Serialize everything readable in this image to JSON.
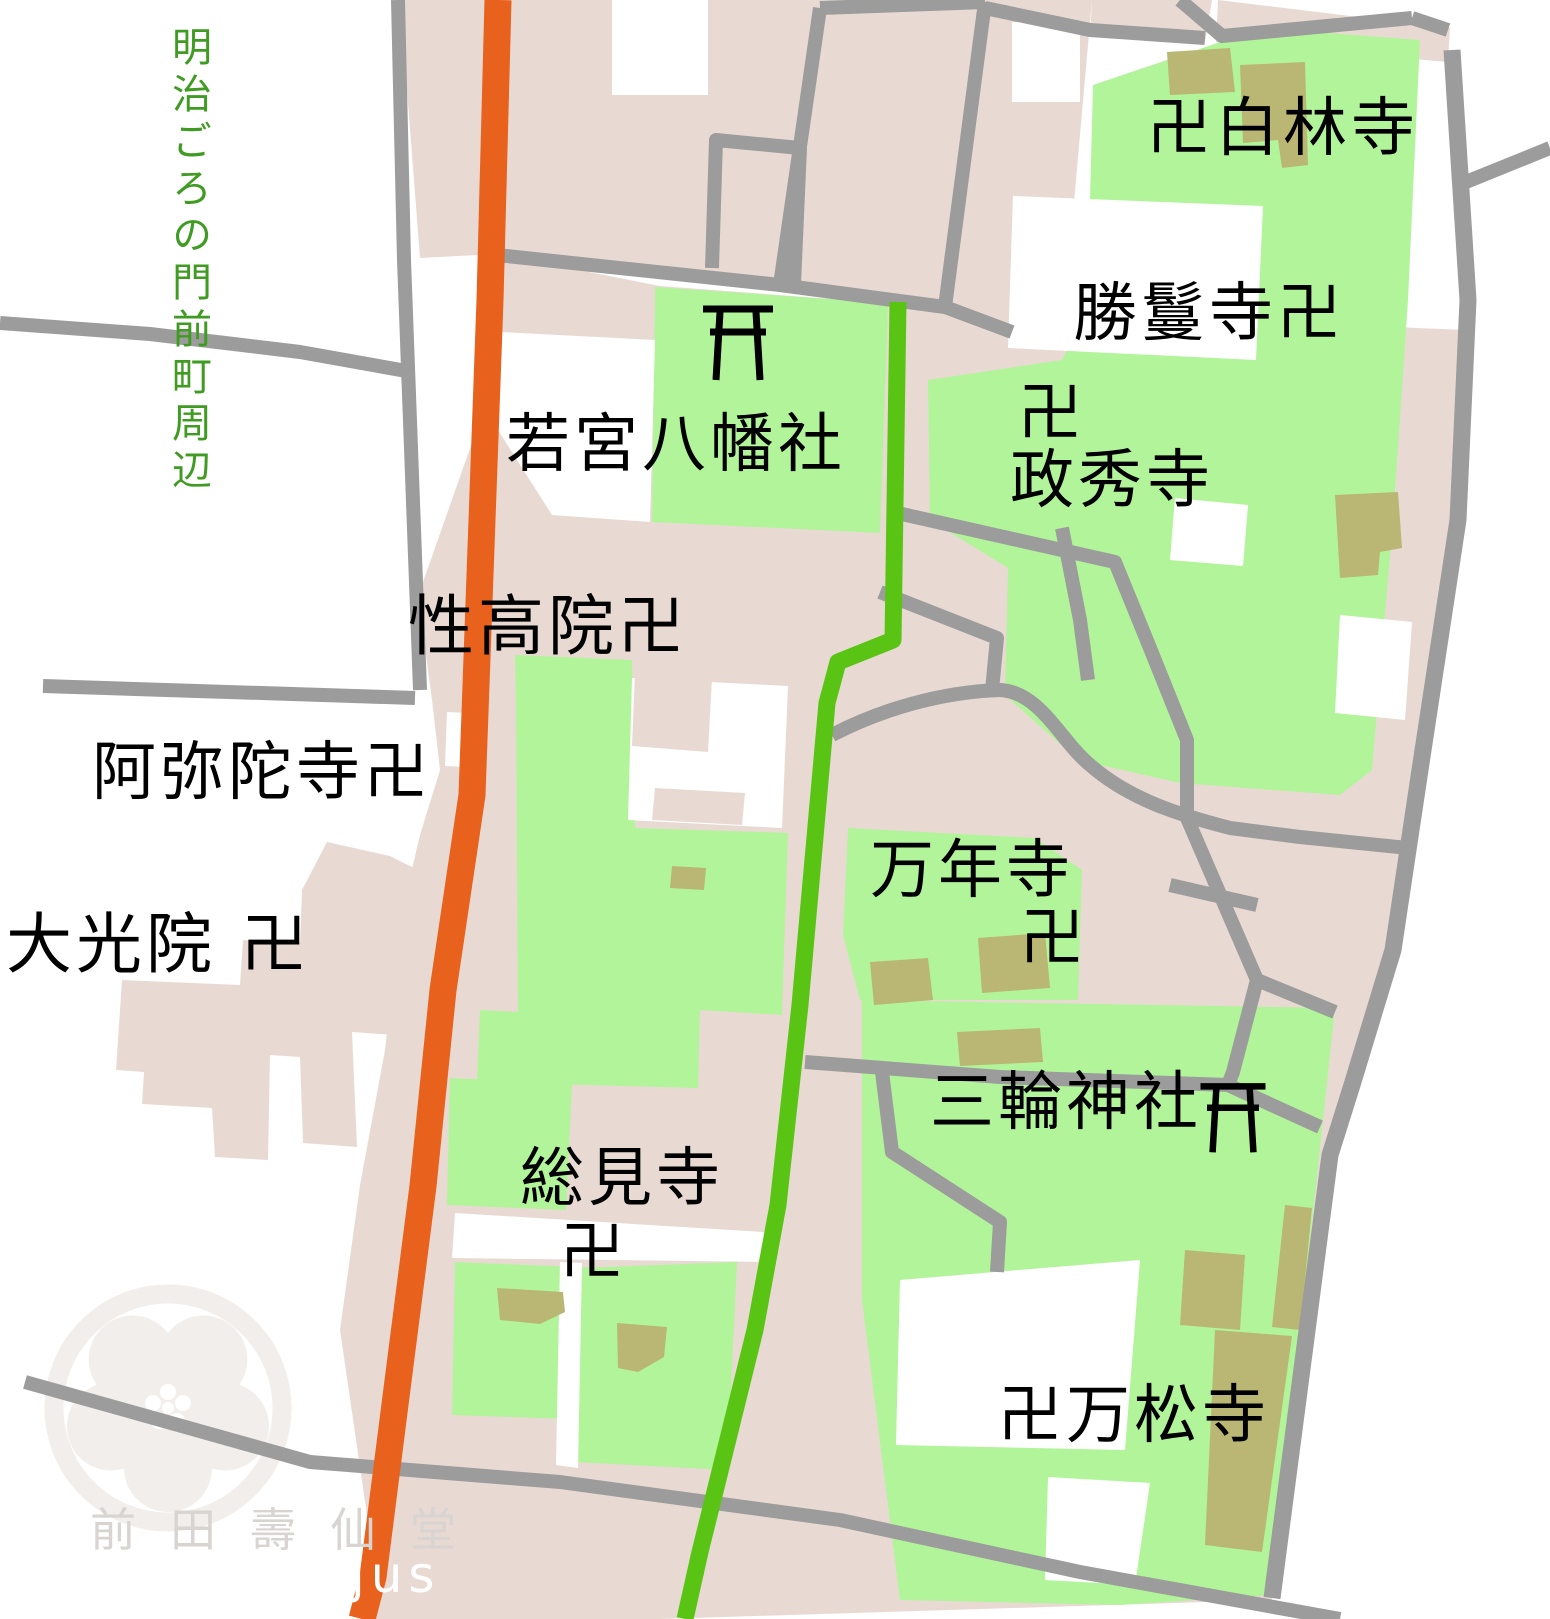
{
  "map": {
    "title": "明治ごろの門前町周辺",
    "labels": {
      "hakurinji": "卍白林寺",
      "shomanji": "勝鬘寺卍",
      "seishuji_manji": "卍",
      "seishuji": "政秀寺",
      "wakamiya": "若宮八幡社",
      "shokoin": "性高院卍",
      "amidaji": "阿弥陀寺卍",
      "daikoin": "大光院 卍",
      "mannenji": "万年寺",
      "mannenji_manji": "卍",
      "miwa": "三輪神社",
      "sokenji": "総見寺",
      "sokenji_manji": "卍",
      "banshoji": "卍万松寺"
    },
    "watermark": {
      "publisher": "前田壽仙堂",
      "url_text": "/jus"
    },
    "colors": {
      "background": "#ffffff",
      "block_pink": "#e8dad3",
      "temple_green": "#b2f49a",
      "building_olive": "#bab673",
      "road_gray": "#9c9c9c",
      "road_orange": "#e8611d",
      "road_green": "#59c414",
      "title_green": "#3f9b22",
      "watermark_gray": "#d8d4d1",
      "watermark_white": "#ffffff",
      "crest_gray": "#f1eeec",
      "label_black": "#000000"
    }
  }
}
